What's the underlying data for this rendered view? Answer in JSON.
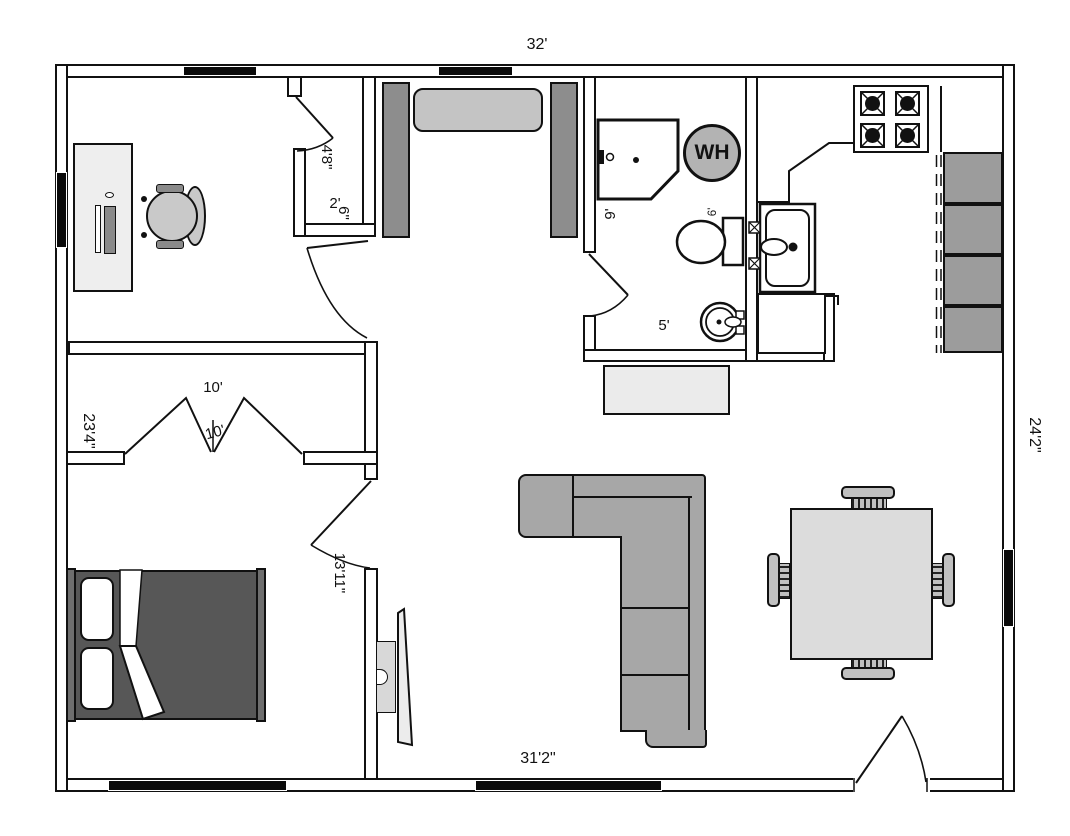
{
  "plan_title": "floor-plan",
  "dimensions": {
    "top_width": "32'",
    "bottom_width": "31'2\"",
    "left_height": "23'4\"",
    "right_height": "24'2\"",
    "living_room": "13'11\"",
    "bedroom_closet_width": "10'",
    "bedroom_closet_door": "10'",
    "office_closet_depth": "4'8\"",
    "office_closet_width_ft": "2'",
    "office_closet_width_in": "6\"",
    "bathroom_length": "9'",
    "bathroom_width": "5'",
    "toilet_clearance": "6'"
  },
  "appliances": {
    "water_heater_label": "WH"
  },
  "furniture": [
    "desk",
    "office-chair",
    "computer-monitor",
    "keyboard",
    "mouse",
    "entry-bench",
    "shower",
    "water-heater",
    "toilet",
    "pedestal-sink",
    "kitchen-sink",
    "refrigerator",
    "stove",
    "base-cabinets",
    "storage-dresser",
    "sectional-sofa",
    "tv",
    "tv-mount",
    "bed",
    "pillows",
    "dining-table",
    "dining-chairs",
    "bifold-closet-doors",
    "swing-doors",
    "windows"
  ],
  "colors": {
    "wall_line": "#111111",
    "partition_gray": "#8d8d8d",
    "cabinet_gray": "#9c9c9c",
    "sofa_gray": "#a7a7a7",
    "wh_gray": "#b3b3b3",
    "bench_gray": "#c4c4c4",
    "chair_gray": "#c9c9c9",
    "dining_chair_gray": "#c0c0c0",
    "table_gray": "#dcdcdc",
    "desk_gray": "#eeeeee",
    "storage_gray": "#ebebeb",
    "bed_dark": "#575757",
    "bed_rail": "#6e6e6e",
    "monitor_gray": "#8a8a8a",
    "tv_gray": "#ececec"
  }
}
